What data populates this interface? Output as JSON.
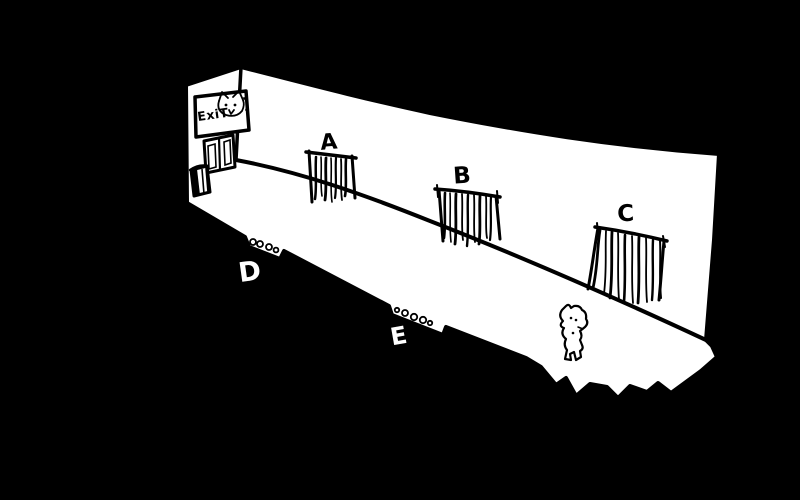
{
  "canvas": {
    "width": 800,
    "height": 500
  },
  "colors": {
    "background": "#000000",
    "paper": "#ffffff",
    "ink": "#000000"
  },
  "exit_sign": {
    "text": "ExiT"
  },
  "windows": [
    {
      "label": "A"
    },
    {
      "label": "B"
    },
    {
      "label": "C"
    }
  ],
  "floor_markers": [
    {
      "label": "D",
      "dots": 4
    },
    {
      "label": "E",
      "dots": 5
    }
  ],
  "icons": {
    "cat_face": "cat-face-icon",
    "creature": "creature-icon",
    "trash_bin": "trash-bin-icon",
    "double_door": "double-door-icon",
    "exit_sign": "exit-sign"
  }
}
